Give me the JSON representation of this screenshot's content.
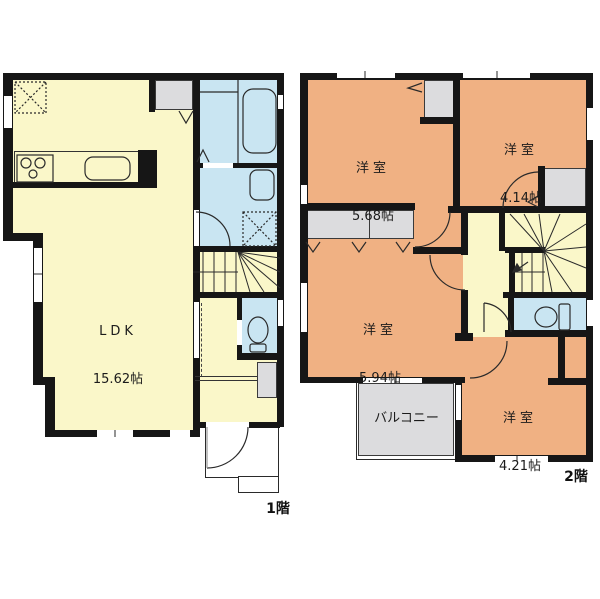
{
  "title": "2-story house floor plan",
  "floor1": {
    "floor_label": "1階",
    "ldk_name": "LDK",
    "ldk_size": "15.62帖"
  },
  "floor2": {
    "floor_label": "2階",
    "balcony_label": "バルコニー",
    "room_a_name": "洋室",
    "room_a_size": "5.68帖",
    "room_b_name": "洋室",
    "room_b_size": "4.14帖",
    "room_c_name": "洋室",
    "room_c_size": "5.94帖",
    "room_d_name": "洋室",
    "room_d_size": "4.21帖"
  },
  "colors": {
    "wall": "#161616",
    "living_yellow": "#faf7c9",
    "bedroom_orange": "#f0b183",
    "sanitary_blue": "#c9e5f2",
    "storage_gray": "#dcdcde",
    "background": "#ffffff"
  }
}
